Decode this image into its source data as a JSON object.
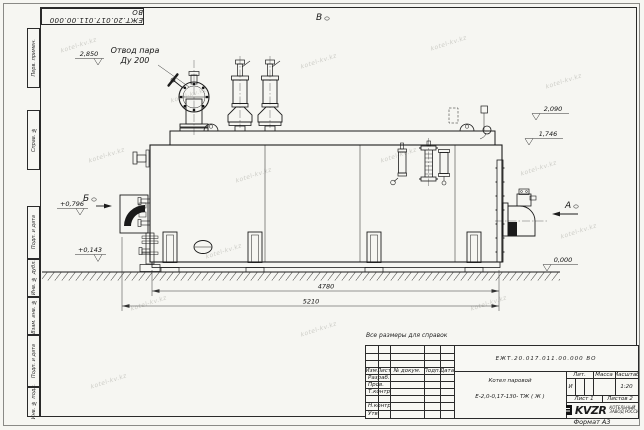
{
  "page": {
    "format": "Формат А3",
    "note": "Все размеры для справок",
    "watermark": "kotel-kv.kz",
    "corner_stamp": "ЕЖТ.20.017.011.00.000  ВО"
  },
  "margin": {
    "perv_primen": "Перв. примен.",
    "sprav_no": "Справ. №",
    "podp_data_top": "Подп. и дата",
    "inv_dubl": "Инв. № дубл.",
    "vzam_inv": "Взам. инв. №",
    "podp_data_bot": "Подп. и дата",
    "inv_podl": "Инв. № подл."
  },
  "drawing": {
    "views": {
      "top": "В",
      "left": "Б",
      "right": "А"
    },
    "callouts": {
      "steam_line1": "Отвод пара",
      "steam_line2": "Ду 200"
    },
    "elevations": {
      "steam": "2,850",
      "top_right": "2,090",
      "mid_right": "1,746",
      "left_upper": "+0,796",
      "left_lower": "+0,143",
      "ground": "0,000"
    },
    "dimensions": {
      "inner_length": "4780",
      "overall_length": "5210"
    }
  },
  "title_block": {
    "designation": "ЕЖТ.20.017.011.00.000  ВО",
    "product_name": "Котел паровой",
    "product_type": "Е-2,0-0,17-130- ТЖ ( Ж )",
    "cols": {
      "izm": "Изм.",
      "list": "Лист",
      "dokum": "№ докум.",
      "podp": "Подп.",
      "data": "Дата"
    },
    "rows": {
      "razrab": "Разраб.",
      "prov": "Пров.",
      "tkontr": "Т.контр.",
      "nkontr": "Н.контр.",
      "utv": "Утв."
    },
    "lit": {
      "header": "Лит.",
      "value": "И"
    },
    "massa": {
      "header": "Масса",
      "value": ""
    },
    "masshtab": {
      "header": "Масштаб",
      "value": "1:20"
    },
    "sheet": {
      "list": "Лист 1",
      "listov": "Листов 2"
    },
    "company": {
      "logo": "KVZR",
      "name_line1": "КОТЕЛЬНЫЙ",
      "name_line2": "ЗАВОД РОССИИ"
    }
  }
}
